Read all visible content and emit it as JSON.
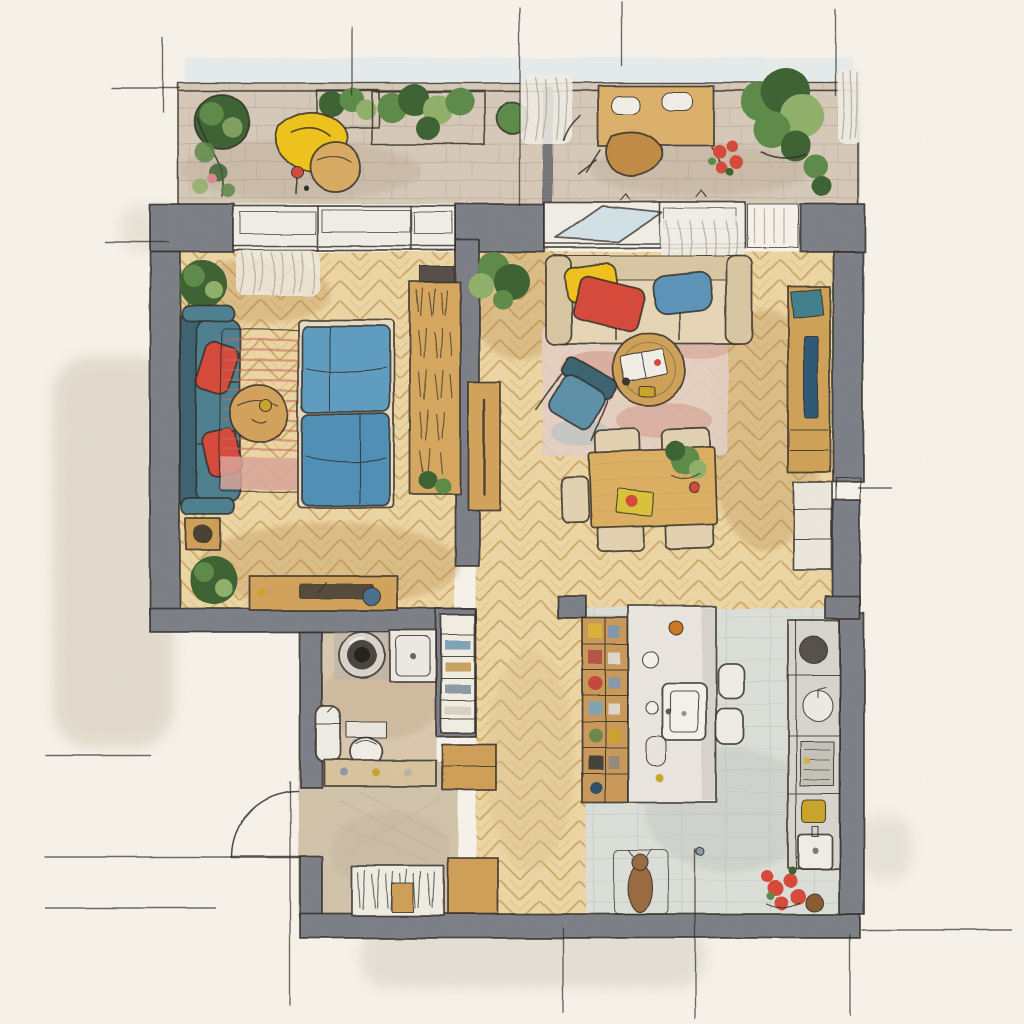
{
  "artwork_type": "hand-drawn watercolor floor plan, top-down view",
  "palette": {
    "paper": "#f7f3ea",
    "ink": "#2f2c27",
    "wall": "#7b7f86",
    "wallDark": "#5e6268",
    "wood": "#ecd6a4",
    "woodLine": "#c49a55",
    "woodShade": "#b98a4e",
    "stone": "#d6c9b8",
    "stoneLine": "#a79884",
    "tile": "#dcded9",
    "tileLine": "#b2b5af",
    "bathFloor": "#d9c7ae",
    "entryFloor": "#d2c3ab",
    "teal": "#4e7f8f",
    "tealDark": "#3a636f",
    "bedBlue": "#5f9cc0",
    "bedBlueDeep": "#4f8fb5",
    "red": "#d64a3b",
    "yellow": "#f0c31f",
    "beige": "#e6d6b6",
    "beigeShade": "#d9c6a2",
    "green": "#5d8a4a",
    "greenDark": "#3e6233",
    "greenLight": "#8fb06a",
    "tan": "#cf9f58",
    "tanDeep": "#b07f3c",
    "white": "#f1eee6",
    "glass": "#cfe0e8",
    "skyWash": "#d8e6ec",
    "rugBase": "#f1e7da",
    "rugStripe": "#c2685c",
    "rugPink": "#d9a49a",
    "rugLiving": "#e4cfc3",
    "rugMottle": "#cf8d7f",
    "rugBlue": "#a9bfc8",
    "screen": "#2e5976",
    "tvTeal": "#3f7f8c",
    "counter": "#d7d5cd",
    "island": "#e9e6df",
    "appliance": "#55514a",
    "mat": "#cdd6d8",
    "dogBrown": "#9a6b3f",
    "potBrown": "#8a5a30",
    "washOutside": "#cfc4b4"
  },
  "scene": {
    "rooms": [
      {
        "name": "terrace-balcony",
        "position": "top",
        "floor": "stone-tile",
        "items": [
          "railing",
          "round-planter-pot",
          "climbing-plant",
          "planter-boxes",
          "yellow-lounge-chair",
          "round-bistro-table",
          "red-cup",
          "privacy-screen",
          "sheer-curtain",
          "outdoor-table-with-plates",
          "wooden-outdoor-chair",
          "red-flower-pot",
          "large-corner-plant"
        ]
      },
      {
        "name": "bedroom",
        "position": "middle-left",
        "floor": "herringbone-parquet",
        "items": [
          "window-curtain",
          "potted-plant",
          "teal-sofa",
          "red-cushion-upper",
          "red-cushion-lower",
          "side-table-with-swirl",
          "round-wooden-table",
          "striped-rug",
          "double-bed-blue-bedding",
          "wardrobe-hanging-clothes",
          "overhead-dark-shelf",
          "sideboard-with-tray",
          "blue-speaker",
          "floor-plant"
        ]
      },
      {
        "name": "living-dining-room",
        "position": "middle-right",
        "floor": "herringbone-parquet",
        "items": [
          "open-window-sash",
          "sheer-curtain",
          "beige-sofa",
          "yellow-cushion",
          "red-cushion",
          "blue-cushion",
          "round-coffee-table",
          "open-book",
          "blue-armchair",
          "mottled-area-rug",
          "dining-table",
          "dining-chairs-x5",
          "table-plant",
          "yellow-serving-tray",
          "red-apple",
          "hall-console",
          "tv-sideboard",
          "tv-screen",
          "lower-cabinet"
        ]
      },
      {
        "name": "bathroom",
        "position": "bottom-left",
        "floor": "stone-beige",
        "items": [
          "washing-machine",
          "shower-tray",
          "wall-sink",
          "toilet",
          "vanity-ledge",
          "towel-niche-shelves",
          "hall-cabinet"
        ]
      },
      {
        "name": "entrance-hall",
        "position": "bottom-left",
        "floor": "stone-beige",
        "items": [
          "entry-door-swing",
          "doormat",
          "coat-closet-hanging-clothes",
          "shoe-cabinet"
        ]
      },
      {
        "name": "kitchen",
        "position": "bottom-right",
        "floor": "gray-tile",
        "items": [
          "open-shelf-with-dishes",
          "kitchen-island",
          "island-sink",
          "bar-stool-1",
          "bar-stool-2",
          "tall-counter",
          "kettle",
          "round-counter-sink",
          "cooktop",
          "yellow-jar",
          "storage-jar",
          "pet-mat",
          "dog",
          "red-flower-pot",
          "clay-pot",
          "utility-sink"
        ]
      }
    ]
  }
}
